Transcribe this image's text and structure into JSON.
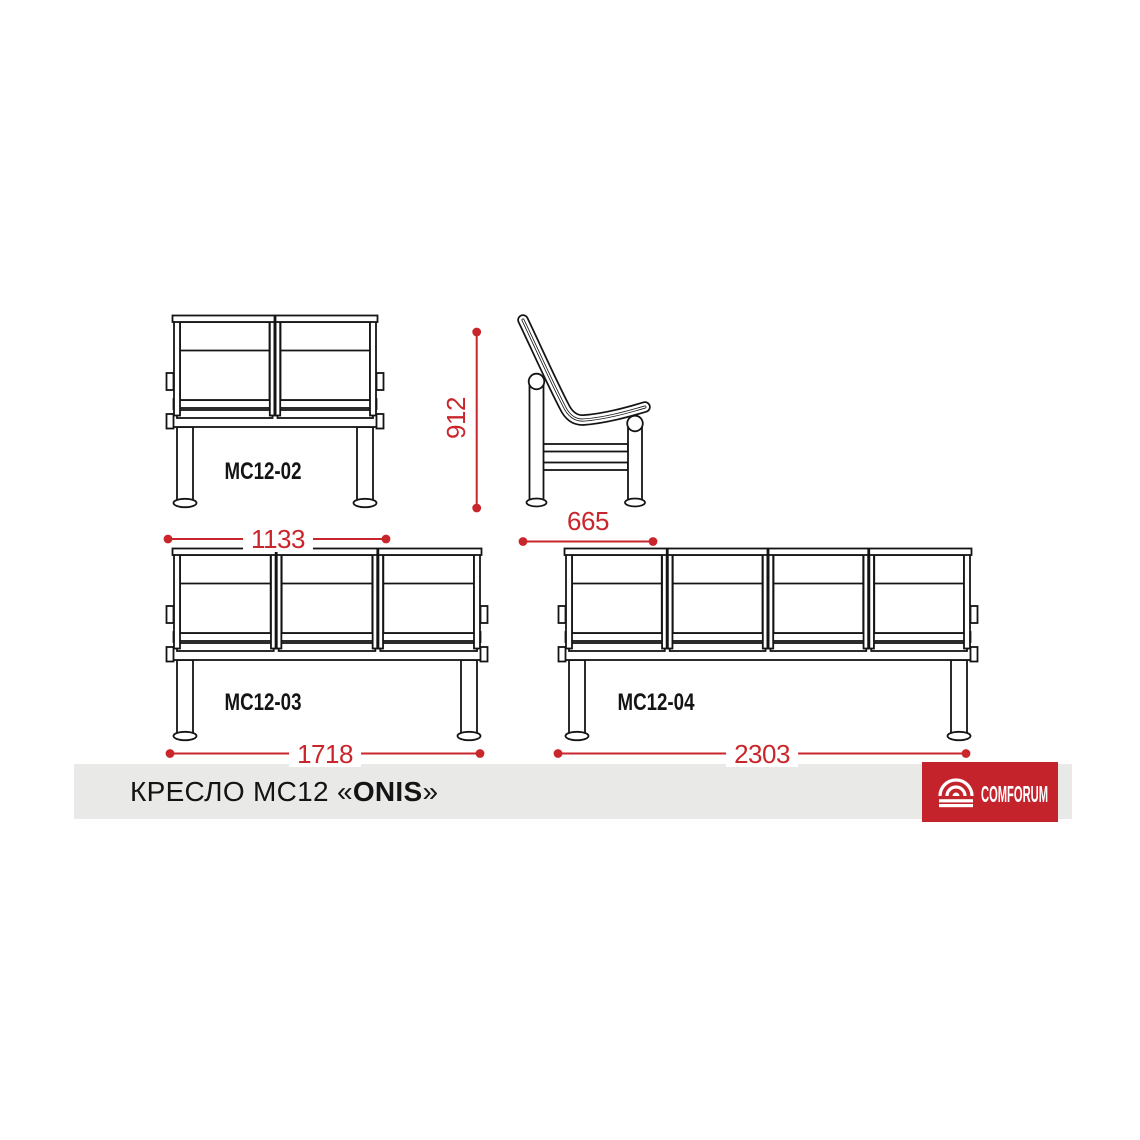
{
  "colors": {
    "dimension_red": "#c9262b",
    "drawing_black": "#141414",
    "footer_bar_gray": "#e9e9e7",
    "brand_red": "#c4232c",
    "brand_text_white": "#ffffff"
  },
  "figures": {
    "front_2seat": {
      "label": "MC12-02",
      "seats": 2,
      "width_mm": "1133"
    },
    "front_3seat": {
      "label": "MC12-03",
      "seats": 3,
      "width_mm": "1718"
    },
    "front_4seat": {
      "label": "MC12-04",
      "seats": 4,
      "width_mm": "2303"
    },
    "side_view": {
      "height_mm": "912",
      "depth_mm": "665"
    }
  },
  "footer": {
    "product_title_regular": "КРЕСЛО MC12 «",
    "product_title_bold": "ONIS",
    "product_title_close": "»",
    "brand": "COMFORUM"
  }
}
